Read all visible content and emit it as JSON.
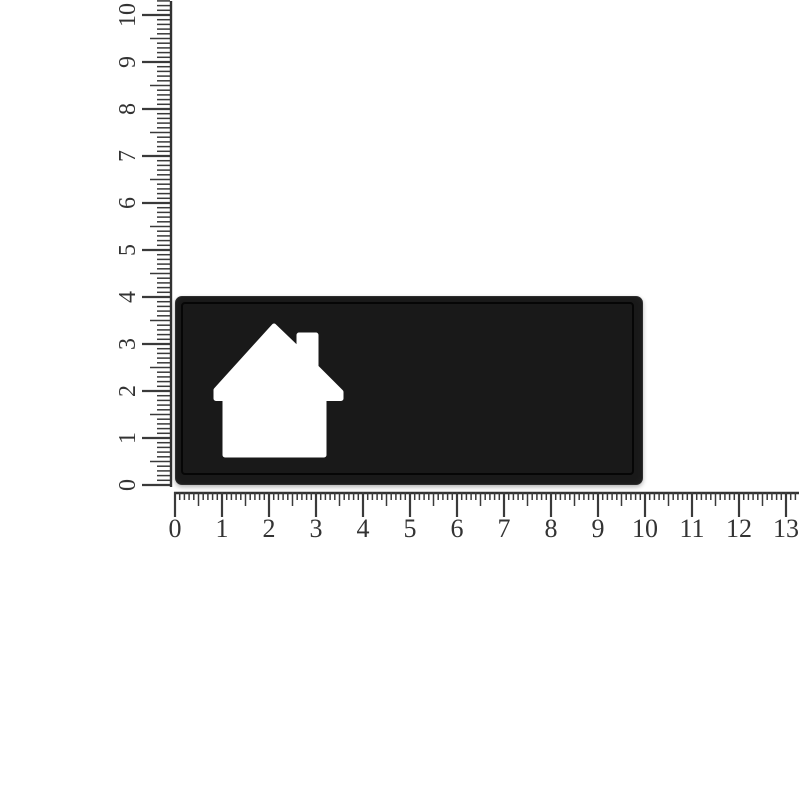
{
  "figure": {
    "background_color": "#ffffff"
  },
  "rulers": {
    "tick_color": "#3a3a3a",
    "baseline_color": "#323232",
    "label_color": "#333333",
    "unit_px": 47,
    "vertical": {
      "min": 0,
      "max": 10,
      "labels": [
        "0",
        "1",
        "2",
        "3",
        "4",
        "5",
        "6",
        "7",
        "8",
        "9",
        "10"
      ]
    },
    "horizontal": {
      "min": 0,
      "max": 13,
      "labels": [
        "0",
        "1",
        "2",
        "3",
        "4",
        "5",
        "6",
        "7",
        "8",
        "9",
        "10",
        "11",
        "12",
        "13"
      ]
    }
  },
  "plate": {
    "color": "#191919",
    "groove_color": "#060606",
    "edge_highlight_color": "#2d2d2d",
    "width_units": 10,
    "height_units": 4,
    "cutout_shape": "house",
    "cutout_color": "#ffffff"
  }
}
